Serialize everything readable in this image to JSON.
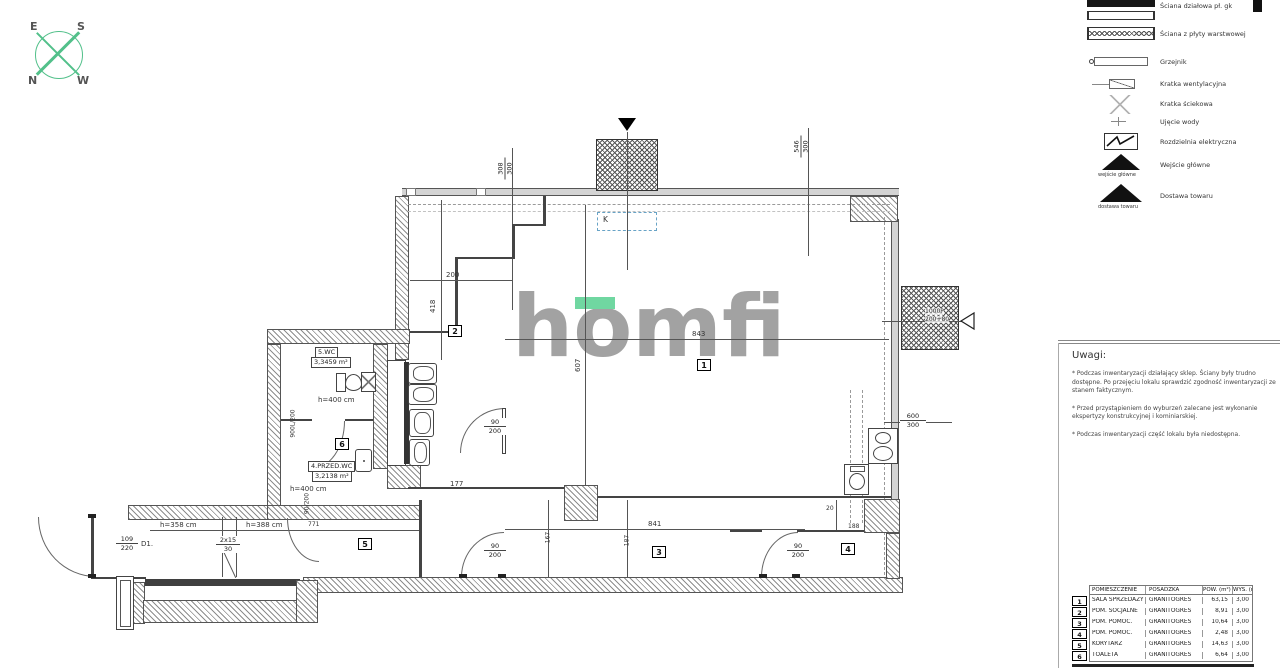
{
  "compass": {
    "e": "E",
    "s": "S",
    "n": "N",
    "w": "W",
    "color": "#52c08a"
  },
  "watermark": {
    "text": "homfi",
    "color": "#a2a2a2",
    "accent": "#70d7a1"
  },
  "legend": {
    "items": [
      {
        "name": "partition-wall",
        "label": "Ściana działowa pł. gk"
      },
      {
        "name": "sandwich-panel-wall",
        "label": "Ściana z płyty warstwowej"
      },
      {
        "name": "radiator",
        "label": "Grzejnik"
      },
      {
        "name": "vent-grille",
        "label": "Kratka wentylacyjna"
      },
      {
        "name": "floor-drain",
        "label": "Kratka ściekowa"
      },
      {
        "name": "water-intake",
        "label": "Ujęcie wody"
      },
      {
        "name": "electrical-panel",
        "label": "Rozdzielnia elektryczna"
      },
      {
        "name": "main-entrance",
        "label": "Wejście główne",
        "caption": "wejście główne"
      },
      {
        "name": "goods-delivery",
        "label": "Dostawa towaru",
        "caption": "dostawa towaru"
      }
    ]
  },
  "notes": {
    "title": "Uwagi:",
    "items": [
      "* Podczas inwentaryzacji działający sklep. Ściany były trudno dostępne. Po przejęciu lokalu sprawdzić zgodność inwentaryzacji ze stanem faktycznym.",
      "* Przed przystąpieniem do wyburzeń zalecane jest wykonanie ekspertyzy konstrukcyjnej i kominiarskiej.",
      "* Podczas inwentaryzacji część lokalu była niedostępna."
    ]
  },
  "room_table": {
    "headers": [
      "POMIESZCZENIE",
      "POSADZKA",
      "POW. (m²)",
      "WYS. (m)"
    ],
    "rows": [
      {
        "no": "1",
        "name": "SALA SPRZEDAŻY",
        "floor": "GRANITOGRES",
        "area": "63,15",
        "height": "3,00"
      },
      {
        "no": "2",
        "name": "POM. SOCJALNE",
        "floor": "GRANITOGRES",
        "area": "8,91",
        "height": "3,00"
      },
      {
        "no": "3",
        "name": "POM. POMOC.",
        "floor": "GRANITOGRES",
        "area": "10,64",
        "height": "3,00"
      },
      {
        "no": "4",
        "name": "POM. POMOC.",
        "floor": "GRANITOGRES",
        "area": "2,48",
        "height": "3,00"
      },
      {
        "no": "5",
        "name": "KORYTARZ",
        "floor": "GRANITOGRES",
        "area": "14,63",
        "height": "3,00"
      },
      {
        "no": "6",
        "name": "TOALETA",
        "floor": "GRANITOGRES",
        "area": "6,64",
        "height": "3,00"
      }
    ]
  },
  "plan": {
    "markers": {
      "r1": "1",
      "r2": "2",
      "r3": "3",
      "r4": "4",
      "r5": "5",
      "r6": "6"
    },
    "k_marker": "K",
    "wc": {
      "name": "5.WC",
      "area": "3,3459 m²",
      "height": "h=400 cm"
    },
    "przedwc": {
      "name": "4.PRZED.WC",
      "area": "3,2138 m²",
      "height": "h=400 cm"
    },
    "corridor": {
      "h1": "h=358 cm",
      "h2": "h=388 cm",
      "len": "771"
    },
    "stairs": {
      "top": "2x15",
      "bottom": "30"
    },
    "entry_door": {
      "top": "109",
      "bottom": "220",
      "label": "D1."
    },
    "windows": {
      "top1": {
        "t": "308",
        "b": "300"
      },
      "top2": {
        "t": "546",
        "b": "300"
      },
      "right": {
        "t": "600",
        "b": "300"
      }
    },
    "delivery": {
      "l1": "1000P",
      "l2": "200+80"
    },
    "doors": {
      "w": "90",
      "h": "200",
      "wc_door": "900L/200",
      "cor_door": "90/200"
    },
    "dims": {
      "room1_w": "843",
      "room1_h": "607",
      "room2_w": "200",
      "room2_h": "418",
      "d177": "177",
      "d841": "841",
      "d167": "167",
      "d187": "187",
      "d20": "20",
      "d188": "188"
    }
  }
}
